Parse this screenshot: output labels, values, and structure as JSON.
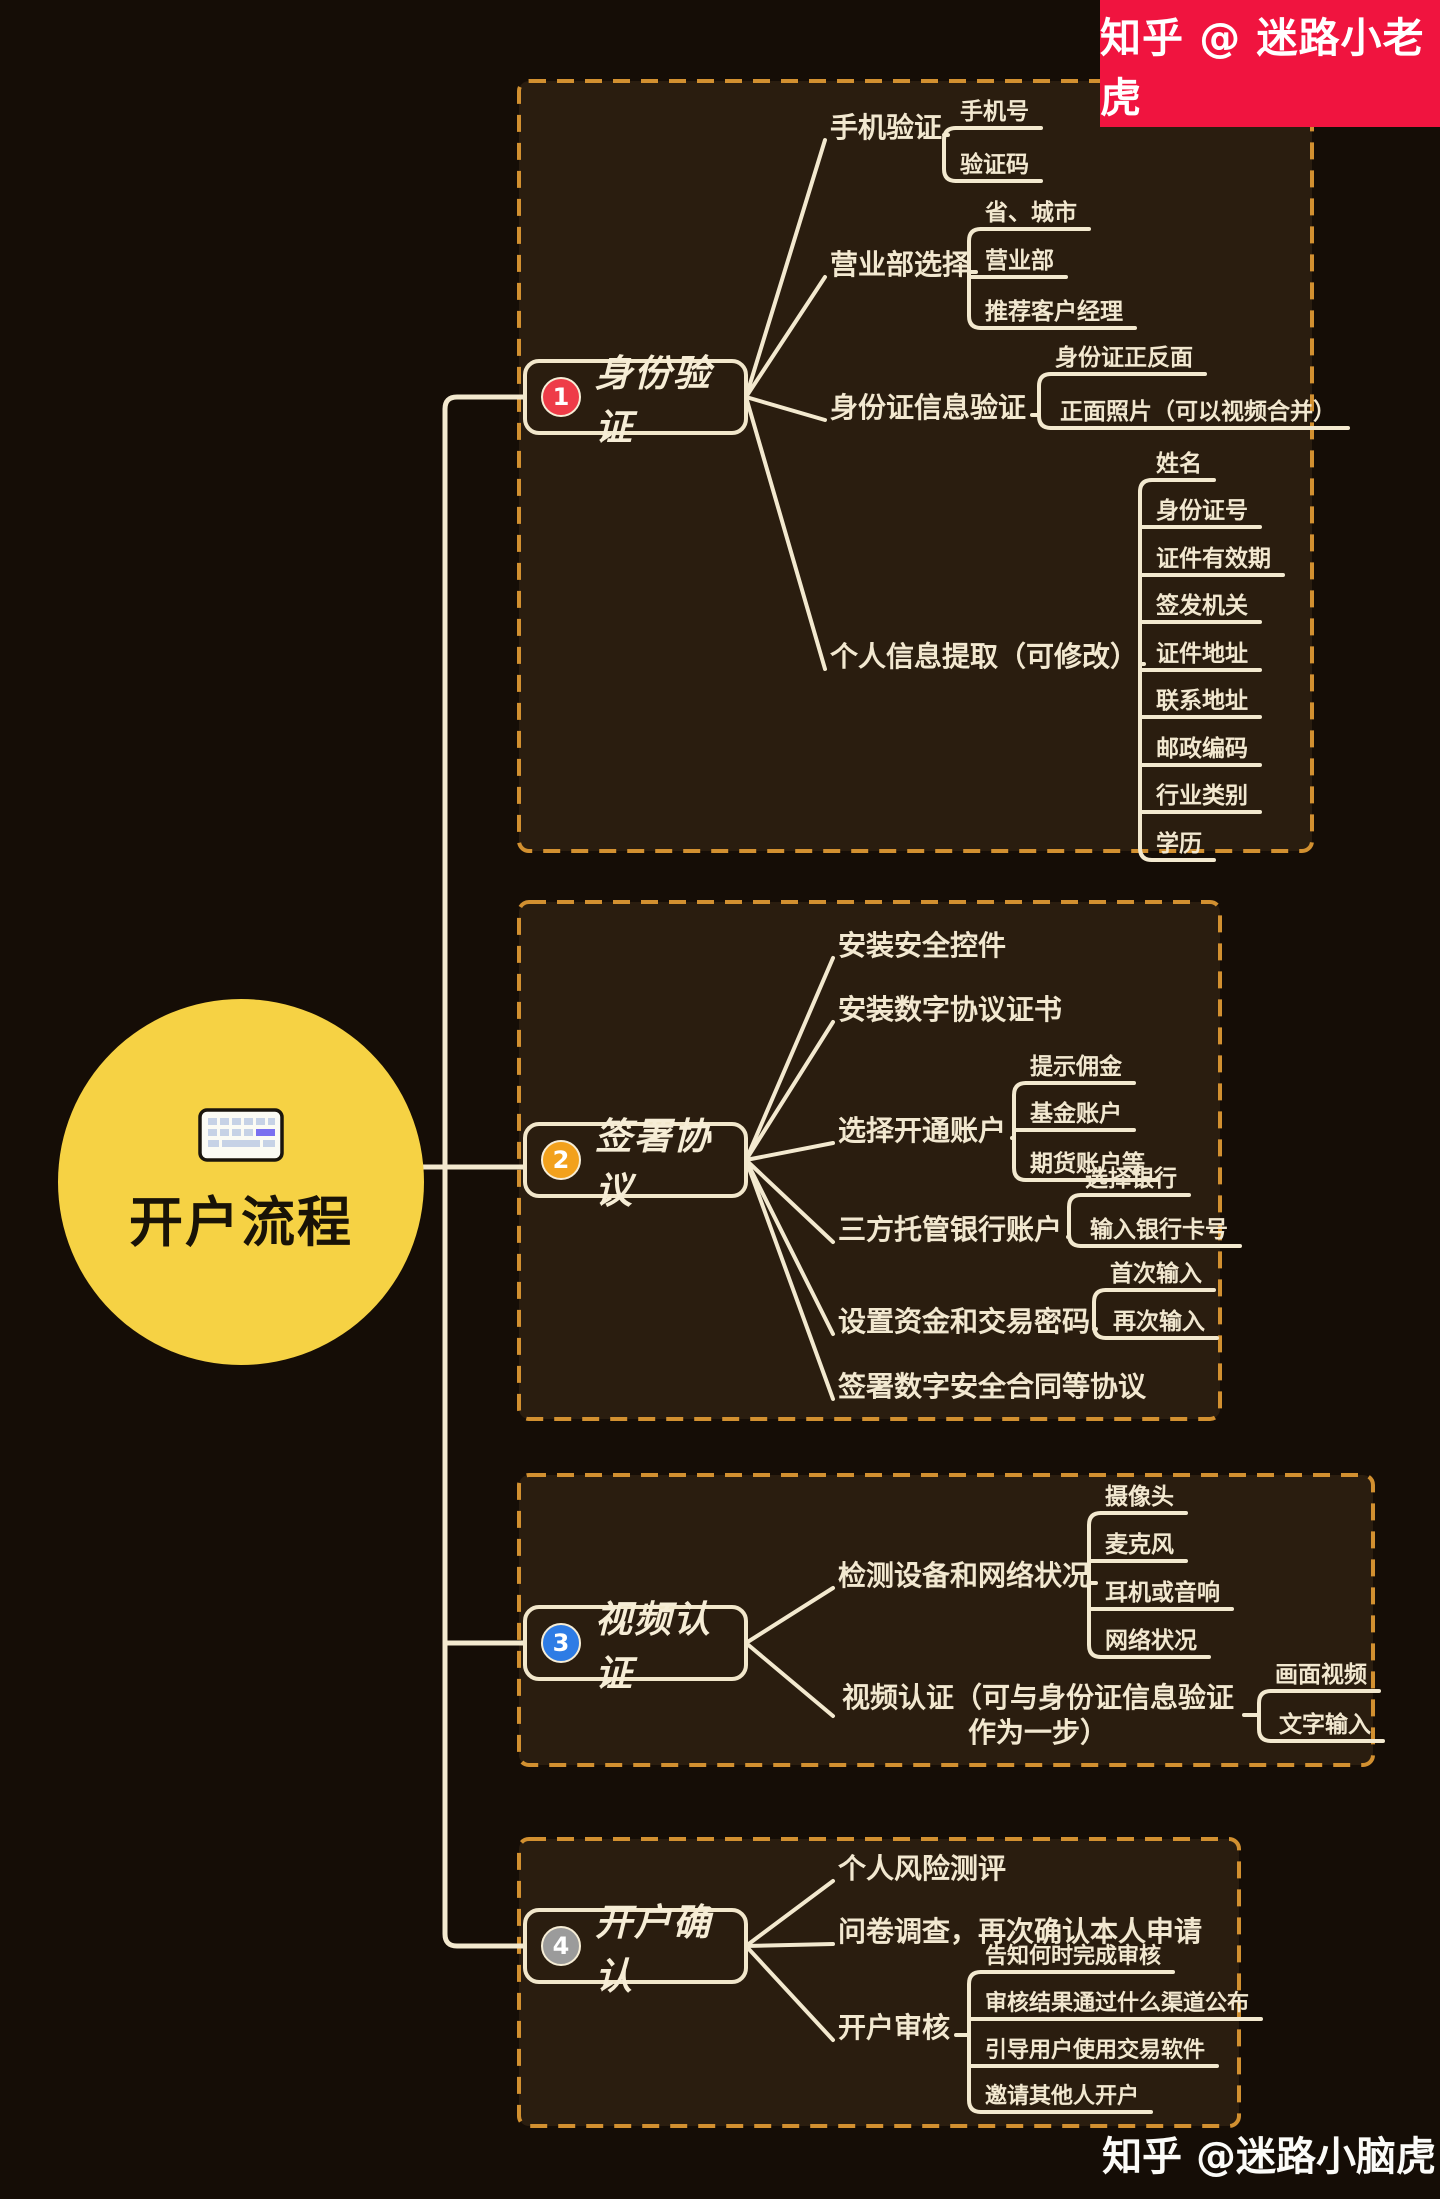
{
  "banner": {
    "text": "知乎 @ 迷路小老虎",
    "bg": "#f0143f"
  },
  "footer": {
    "text": "知乎 @迷路小脑虎"
  },
  "central": {
    "title": "开户流程",
    "icon": "keyboard-icon",
    "circle_color": "#f6d244"
  },
  "theme": {
    "page_bg": "#150d06",
    "box_fill": "#2a1d0f",
    "box_dash": "#d29030",
    "line": "#f3e9cf"
  },
  "branches": [
    {
      "number": "1",
      "color": "#ee3c48",
      "title": "身份验证",
      "children": [
        {
          "label": "手机验证",
          "children": [
            {
              "label": "手机号"
            },
            {
              "label": "验证码"
            }
          ]
        },
        {
          "label": "营业部选择",
          "children": [
            {
              "label": "省、城市"
            },
            {
              "label": "营业部"
            },
            {
              "label": "推荐客户经理"
            }
          ]
        },
        {
          "label": "身份证信息验证",
          "children": [
            {
              "label": "身份证正反面"
            },
            {
              "label": "正面照片（可以视频合并）"
            }
          ]
        },
        {
          "label": "个人信息提取（可修改）",
          "children": [
            {
              "label": "姓名"
            },
            {
              "label": "身份证号"
            },
            {
              "label": "证件有效期"
            },
            {
              "label": "签发机关"
            },
            {
              "label": "证件地址"
            },
            {
              "label": "联系地址"
            },
            {
              "label": "邮政编码"
            },
            {
              "label": "行业类别"
            },
            {
              "label": "学历"
            }
          ]
        }
      ]
    },
    {
      "number": "2",
      "color": "#f2a11c",
      "title": "签署协议",
      "children": [
        {
          "label": "安装安全控件"
        },
        {
          "label": "安装数字协议证书"
        },
        {
          "label": "选择开通账户",
          "children": [
            {
              "label": "提示佣金"
            },
            {
              "label": "基金账户"
            },
            {
              "label": "期货账户等"
            }
          ]
        },
        {
          "label": "三方托管银行账户",
          "children": [
            {
              "label": "选择银行"
            },
            {
              "label": "输入银行卡号"
            }
          ]
        },
        {
          "label": "设置资金和交易密码",
          "children": [
            {
              "label": "首次输入"
            },
            {
              "label": "再次输入"
            }
          ]
        },
        {
          "label": "签署数字安全合同等协议"
        }
      ]
    },
    {
      "number": "3",
      "color": "#2e7ce5",
      "title": "视频认证",
      "children": [
        {
          "label": "检测设备和网络状况",
          "children": [
            {
              "label": "摄像头"
            },
            {
              "label": "麦克风"
            },
            {
              "label": "耳机或音响"
            },
            {
              "label": "网络状况"
            }
          ]
        },
        {
          "label": "视频认证（可与身份证信息验证作为一步）",
          "children": [
            {
              "label": "画面视频"
            },
            {
              "label": "文字输入"
            }
          ]
        }
      ]
    },
    {
      "number": "4",
      "color": "#9b9b9b",
      "title": "开户确认",
      "children": [
        {
          "label": "个人风险测评"
        },
        {
          "label": "问卷调查，再次确认本人申请"
        },
        {
          "label": "开户审核",
          "children": [
            {
              "label": "告知何时完成审核"
            },
            {
              "label": "审核结果通过什么渠道公布"
            },
            {
              "label": "引导用户使用交易软件"
            },
            {
              "label": "邀请其他人开户"
            }
          ]
        }
      ]
    }
  ]
}
